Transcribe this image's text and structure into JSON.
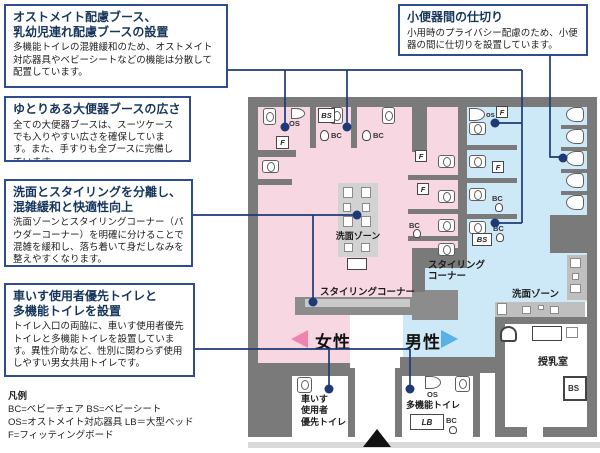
{
  "callouts": [
    {
      "title": "オストメイト配慮ブース、\n乳幼児連れ配慮ブースの設置",
      "body": "多機能トイレの混雑緩和のため、オストメイト対応器具やベビーシートなどの機能は分散して配置しています。"
    },
    {
      "title": "ゆとりある大便器ブースの広さ",
      "body": "全ての大便器ブースは、スーツケースでも入りやすい広さを確保しています。また、手すりも全ブースに完備しています。"
    },
    {
      "title": "洗面とスタイリングを分離し、\n混雑緩和と快適性向上",
      "body": "洗面ゾーンとスタイリングコーナー（パウダーコーナー）を明確に分けることで混雑を緩和し、落ち着いて身だしなみを整えやすくなります。"
    },
    {
      "title": "車いす使用者優先トイレと\n多機能トイレを設置",
      "body": "トイレ入口の両脇に、車いす使用者優先トイレと多機能トイレを設置しています。異性介助など、性別に関わらず使用しやすい男女共用トイレです。"
    },
    {
      "title": "小便器間の仕切り",
      "body": "小用時のプライバシー配慮のため、小便器の間に仕切りを設置しています。"
    }
  ],
  "legend": {
    "title": "凡例",
    "lines": [
      "BC=ベビーチェア  BS=ベビーシート",
      "OS=オストメイト対応器具  LB＝大型ベッド",
      "F=フィッティングボード"
    ]
  },
  "plan": {
    "gender": {
      "female": "女性",
      "male": "男性"
    },
    "labels": {
      "wash_female": "洗面ゾーン",
      "styling_female": "スタイリングコーナー",
      "styling_male": "スタイリング\nコーナー",
      "wash_male": "洗面ゾーン",
      "nursing": "授乳室",
      "wheelchair": "車いす\n使用者\n優先トイレ",
      "multifunction": "多機能トイレ"
    },
    "tags": {
      "os": "OS",
      "os_small": "os",
      "bs": "BS",
      "bc": "BC",
      "f": "F",
      "lb": "LB"
    }
  },
  "colors": {
    "accent": "#1e3a76",
    "female": "#f7d8e2",
    "male": "#cde8f6",
    "wall": "#7a7a7a",
    "female_arrow": "#ef84b1",
    "male_arrow": "#57b1e6"
  }
}
